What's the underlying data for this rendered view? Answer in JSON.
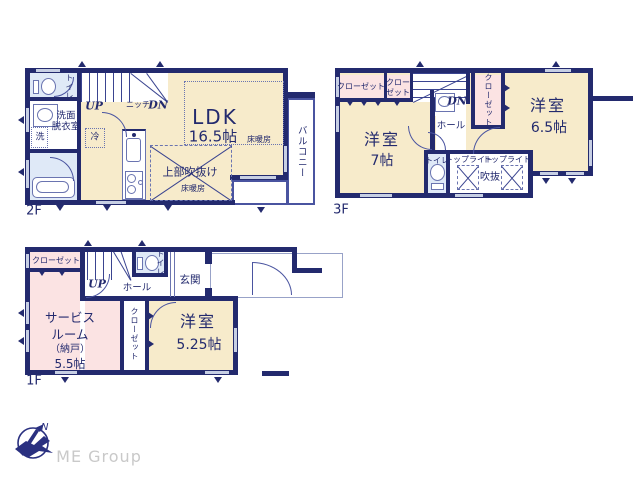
{
  "colors": {
    "wall_navy": "#232a6e",
    "room_cream": "#f7ebcb",
    "room_pink": "#fbe3e3",
    "room_blue": "#dfe9f7",
    "fixture_line": "#6a74b0",
    "window_light": "#c7cfe4",
    "logo_navy": "#2a3080",
    "logo_text_gray": "#c9c9c9"
  },
  "floor2": {
    "label": "2F",
    "toilet": "トイレ",
    "washroom1": "洗面",
    "washroom2": "脱衣室",
    "washer": "洗",
    "fridge": "冷",
    "up": "UP",
    "niche": "ニッチ",
    "dn": "DN",
    "ldk_name": "LDK",
    "ldk_size": "16.5帖",
    "ldk_heating": "床暖房",
    "void_name": "上部吹抜け",
    "void_heating": "床暖房",
    "balcony": "バルコニー"
  },
  "floor3": {
    "label": "3F",
    "closet_a": "クローゼット",
    "closet_b_line1": "クロー",
    "closet_b_line2": "ゼット",
    "closet_c": "クローゼット",
    "dn": "DN",
    "room7_name": "洋室",
    "room7_size": "7帖",
    "hall": "ホール",
    "toilet": "トイレ",
    "toplight_left": "トップライト",
    "toplight_right": "トップライト",
    "void_name": "吹抜",
    "room65_name": "洋室",
    "room65_size": "6.5帖"
  },
  "floor1": {
    "label": "1F",
    "closet_a": "クローゼット",
    "up": "UP",
    "toilet": "トイレ",
    "hall": "ホール",
    "entrance": "玄関",
    "service_line1": "サービス",
    "service_line2": "ルーム",
    "service_line3": "（納戸）",
    "service_size": "5.5帖",
    "closet_b": "クローゼット",
    "room525_name": "洋室",
    "room525_size": "5.25帖"
  },
  "logo": {
    "north": "N",
    "company": "ME Group"
  }
}
